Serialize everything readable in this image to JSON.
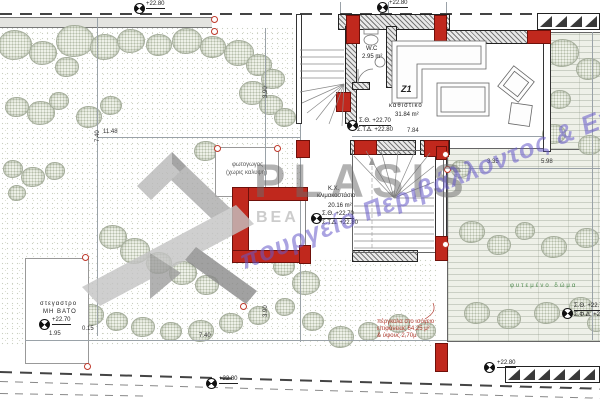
{
  "colors": {
    "accent_red": "#c0281d",
    "watermark_gray": "#6c6c6c",
    "watermark_blue": "#6458c8",
    "tree_green": "#a6ae9c",
    "deck_green": "#eef0e8"
  },
  "watermark": {
    "logo": "PLASIS",
    "fragment": "BEA",
    "tagline": "πουργείο Περιβάλλοντος & Ενέ"
  },
  "levels": {
    "top_left": "+22.80",
    "top_mid": "+22.80",
    "bottom_left": "+22.80",
    "bottom_mid": "+22.80",
    "canopy": "+22.70",
    "living_floor": "Σ.Θ. +22.70",
    "living_slab": "Σ.Τ.Δ. +22.80",
    "stair_floor": "Σ.Θ. +22.70",
    "stair_slab": "Σ.Τ.Δ. +22.80",
    "right_floor": "Σ.Θ. +22.7",
    "right_slab": "Σ.Φ.Δ. +22."
  },
  "rooms": {
    "z1_tag": "Z1",
    "z1_name": "καθιστικο",
    "z1_area": "31.84 m²",
    "wc_name": "W.C",
    "wc_area": "2.95 m²",
    "stair_tag": "Κ.Χ.",
    "stair_name": "κλιμακοστάσιο",
    "stair_area": "20.16 m²",
    "lightwell_line1": "φωτογωγος",
    "lightwell_line2": "(χωρις καλυψη)",
    "green_roof": "φυτεμένο δώμα",
    "canopy_line1": "στεγαστρο",
    "canopy_line2": "ΜΗ ΒΑΤΟ"
  },
  "annotations": {
    "pergola_line1": "πέργκολα στο ισόγειο",
    "pergola_line2": "επιφάνειας 64,25 μ²",
    "pergola_line3": "& ύψους 2,70μ"
  },
  "dimensions": [
    {
      "t": "11.48",
      "x": 103,
      "y": 129,
      "r": 0
    },
    {
      "t": "7.40",
      "x": 95,
      "y": 142,
      "r": -90
    },
    {
      "t": "3.90",
      "x": 263,
      "y": 98,
      "r": -90
    },
    {
      "t": "7.84",
      "x": 407,
      "y": 128,
      "r": 0
    },
    {
      "t": "3.35",
      "x": 487,
      "y": 159,
      "r": 0
    },
    {
      "t": "5.98",
      "x": 541,
      "y": 159,
      "r": 0
    },
    {
      "t": "0.15",
      "x": 82,
      "y": 326,
      "r": 0
    },
    {
      "t": "1.95",
      "x": 49,
      "y": 331,
      "r": 0
    },
    {
      "t": "7.40",
      "x": 199,
      "y": 333,
      "r": 0
    },
    {
      "t": "3.90",
      "x": 263,
      "y": 317,
      "r": -90
    }
  ],
  "trees": [
    [
      14,
      44,
      16
    ],
    [
      42,
      52,
      13
    ],
    [
      74,
      40,
      18
    ],
    [
      104,
      46,
      14
    ],
    [
      66,
      66,
      11
    ],
    [
      130,
      40,
      13
    ],
    [
      158,
      44,
      12
    ],
    [
      186,
      40,
      14
    ],
    [
      212,
      46,
      12
    ],
    [
      238,
      52,
      14
    ],
    [
      258,
      64,
      12
    ],
    [
      272,
      78,
      11
    ],
    [
      252,
      92,
      13
    ],
    [
      270,
      104,
      11
    ],
    [
      284,
      116,
      10
    ],
    [
      16,
      106,
      11
    ],
    [
      40,
      112,
      13
    ],
    [
      58,
      100,
      9
    ],
    [
      88,
      116,
      12
    ],
    [
      110,
      104,
      10
    ],
    [
      12,
      168,
      9
    ],
    [
      32,
      176,
      11
    ],
    [
      54,
      170,
      9
    ],
    [
      16,
      192,
      8
    ],
    [
      205,
      150,
      11
    ],
    [
      225,
      164,
      9
    ],
    [
      112,
      236,
      13
    ],
    [
      134,
      250,
      14
    ],
    [
      158,
      262,
      12
    ],
    [
      182,
      272,
      13
    ],
    [
      206,
      284,
      11
    ],
    [
      283,
      265,
      10
    ],
    [
      305,
      282,
      13
    ],
    [
      64,
      306,
      11
    ],
    [
      90,
      314,
      12
    ],
    [
      116,
      320,
      10
    ],
    [
      142,
      326,
      11
    ],
    [
      170,
      330,
      10
    ],
    [
      200,
      330,
      12
    ],
    [
      230,
      322,
      11
    ],
    [
      258,
      314,
      10
    ],
    [
      284,
      306,
      9
    ],
    [
      312,
      320,
      10
    ],
    [
      340,
      336,
      12
    ],
    [
      368,
      330,
      10
    ],
    [
      398,
      322,
      10
    ],
    [
      425,
      330,
      9
    ],
    [
      562,
      52,
      15
    ],
    [
      588,
      68,
      12
    ],
    [
      559,
      98,
      10
    ],
    [
      553,
      133,
      11
    ],
    [
      589,
      144,
      11
    ],
    [
      460,
      168,
      9
    ],
    [
      471,
      231,
      12
    ],
    [
      498,
      244,
      11
    ],
    [
      524,
      230,
      9
    ],
    [
      553,
      246,
      12
    ],
    [
      586,
      237,
      11
    ],
    [
      476,
      312,
      12
    ],
    [
      508,
      318,
      11
    ],
    [
      546,
      312,
      12
    ],
    [
      580,
      306,
      11
    ],
    [
      596,
      322,
      9
    ]
  ],
  "survey_circles": [
    [
      211,
      16
    ],
    [
      211,
      28
    ],
    [
      82,
      254
    ],
    [
      84,
      363
    ],
    [
      240,
      303
    ],
    [
      442,
      151
    ],
    [
      442,
      241
    ],
    [
      214,
      145
    ],
    [
      274,
      145
    ],
    [
      444,
      166
    ]
  ]
}
